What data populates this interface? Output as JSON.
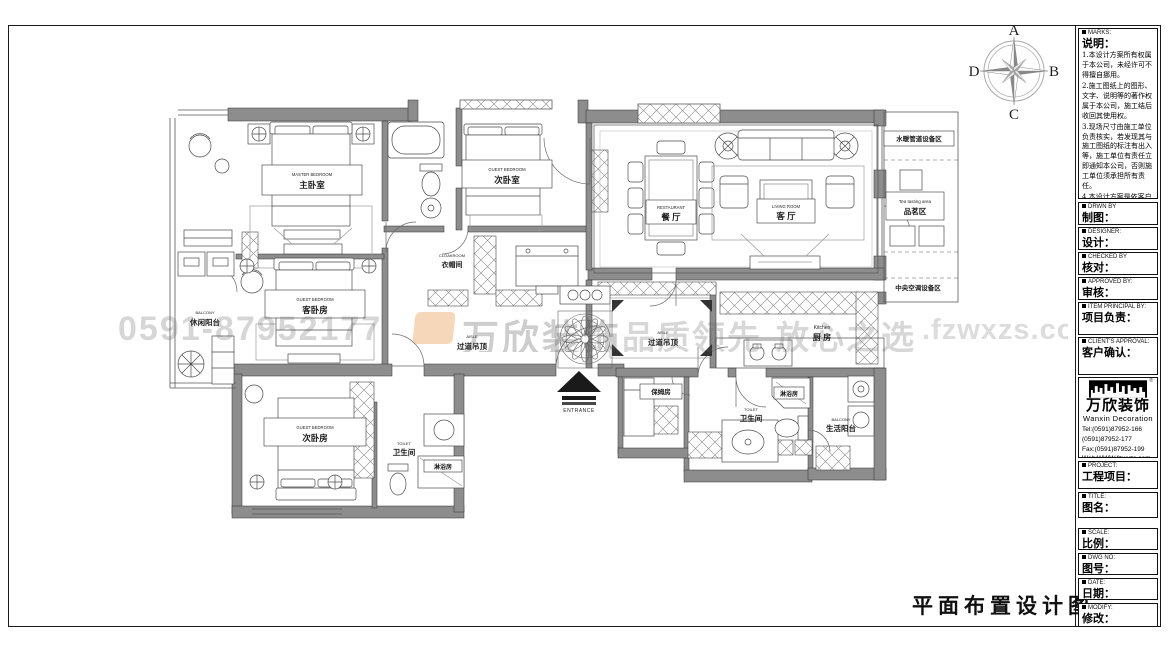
{
  "compass": {
    "n": "A",
    "e": "B",
    "s": "C",
    "w": "D"
  },
  "drawing_title": "平面布置设计图",
  "watermark": {
    "phone": "0591-87952177",
    "brand": "万欣装饰",
    "slogan1": "品质领先",
    "slogan2": "放心之选",
    "domain": ".fzwxzs.com"
  },
  "rooms": {
    "master": {
      "en": "MASTER BEDROOM",
      "cn": "主卧室"
    },
    "bedroom2": {
      "en": "GUEST BEDROOM",
      "cn": "次卧室"
    },
    "guest": {
      "en": "GUEST BEDROOM",
      "cn": "客卧房"
    },
    "bedroom3": {
      "en": "GUEST BEDROOM",
      "cn": "次卧房"
    },
    "dining": {
      "en": "RESTAURANT",
      "cn": "餐 厅"
    },
    "living": {
      "en": "LIVING ROOM",
      "cn": "客 厅"
    },
    "kitchen": {
      "en": "Kitchen",
      "cn": "厨 房"
    },
    "cloakroom": {
      "en": "CLOAKROOM",
      "cn": "衣帽间"
    },
    "aisle1": {
      "en": "AISLE",
      "cn": "过道吊顶"
    },
    "aisle2": {
      "en": "AISLE",
      "cn": "过道吊顶"
    },
    "nanny": {
      "cn": "保姆房"
    },
    "toilet_main": {
      "en": "TOILET",
      "cn": "卫生间"
    },
    "toilet2": {
      "en": "TOILET",
      "cn": "卫生间"
    },
    "shower_main": {
      "cn": "淋浴房"
    },
    "shower2": {
      "cn": "淋浴房"
    },
    "balcony_leisure": {
      "en": "BALCONY",
      "cn": "休闲阳台"
    },
    "balcony_service": {
      "en": "BALCONY",
      "cn": "生活阳台"
    },
    "plumbing_area": {
      "cn": "水暖管道设备区"
    },
    "tea_area": {
      "en": "Tea tasting area",
      "cn": "品茗区"
    },
    "hvac_area": {
      "cn": "中央空调设备区"
    },
    "entrance": {
      "en": "ENTRANCE"
    }
  },
  "title_block": {
    "marks_tag": "MARKS:",
    "marks_label": "说明：",
    "notes": [
      "1.本设计方案所有权属于本公司，未经许可不得擅自挪用。",
      "2.施工图纸上的图形、文字、说明等的著作权属于本公司，施工结后收回其使用权。",
      "3.现场尺寸由施工单位负责核实，若发现其与施工图纸的标注有出入等，施工单位有责任立即通知本公司，否则施工单位须承担所有责任。",
      "4.本设计方案是依客户要求设计，经客户签字即视为同意认可，不得随意更改。"
    ],
    "fields": [
      {
        "tag": "DRWN BY",
        "label": "制图："
      },
      {
        "tag": "DESIGNER:",
        "label": "设计："
      },
      {
        "tag": "CHECKED BY",
        "label": "核对："
      },
      {
        "tag": "APPROVED BY:",
        "label": "审核："
      },
      {
        "tag": "ITEM PRINCIPAL BY:",
        "label": "项目负责："
      },
      {
        "tag": "CLIENT'S APPROVAL:",
        "label": "客户确认："
      }
    ],
    "logo": {
      "name": "万欣装饰",
      "name_en": "Wanxin Decoration",
      "tel1": "Tel:(0591)87952-166",
      "tel2": "(0591)87952-177",
      "fax": "Fax:(0591)87952-199",
      "web": "Web:WWW.fzwxzs.com"
    },
    "fields2": [
      {
        "tag": "PROJECT:",
        "label": "工程项目："
      },
      {
        "tag": "TITLE:",
        "label": "图名："
      },
      {
        "tag": "SCALE:",
        "label": "比例："
      },
      {
        "tag": "DWG NO:",
        "label": "图号："
      },
      {
        "tag": "DATE:",
        "label": "日期："
      },
      {
        "tag": "MODIFY:",
        "label": "修改："
      }
    ]
  }
}
